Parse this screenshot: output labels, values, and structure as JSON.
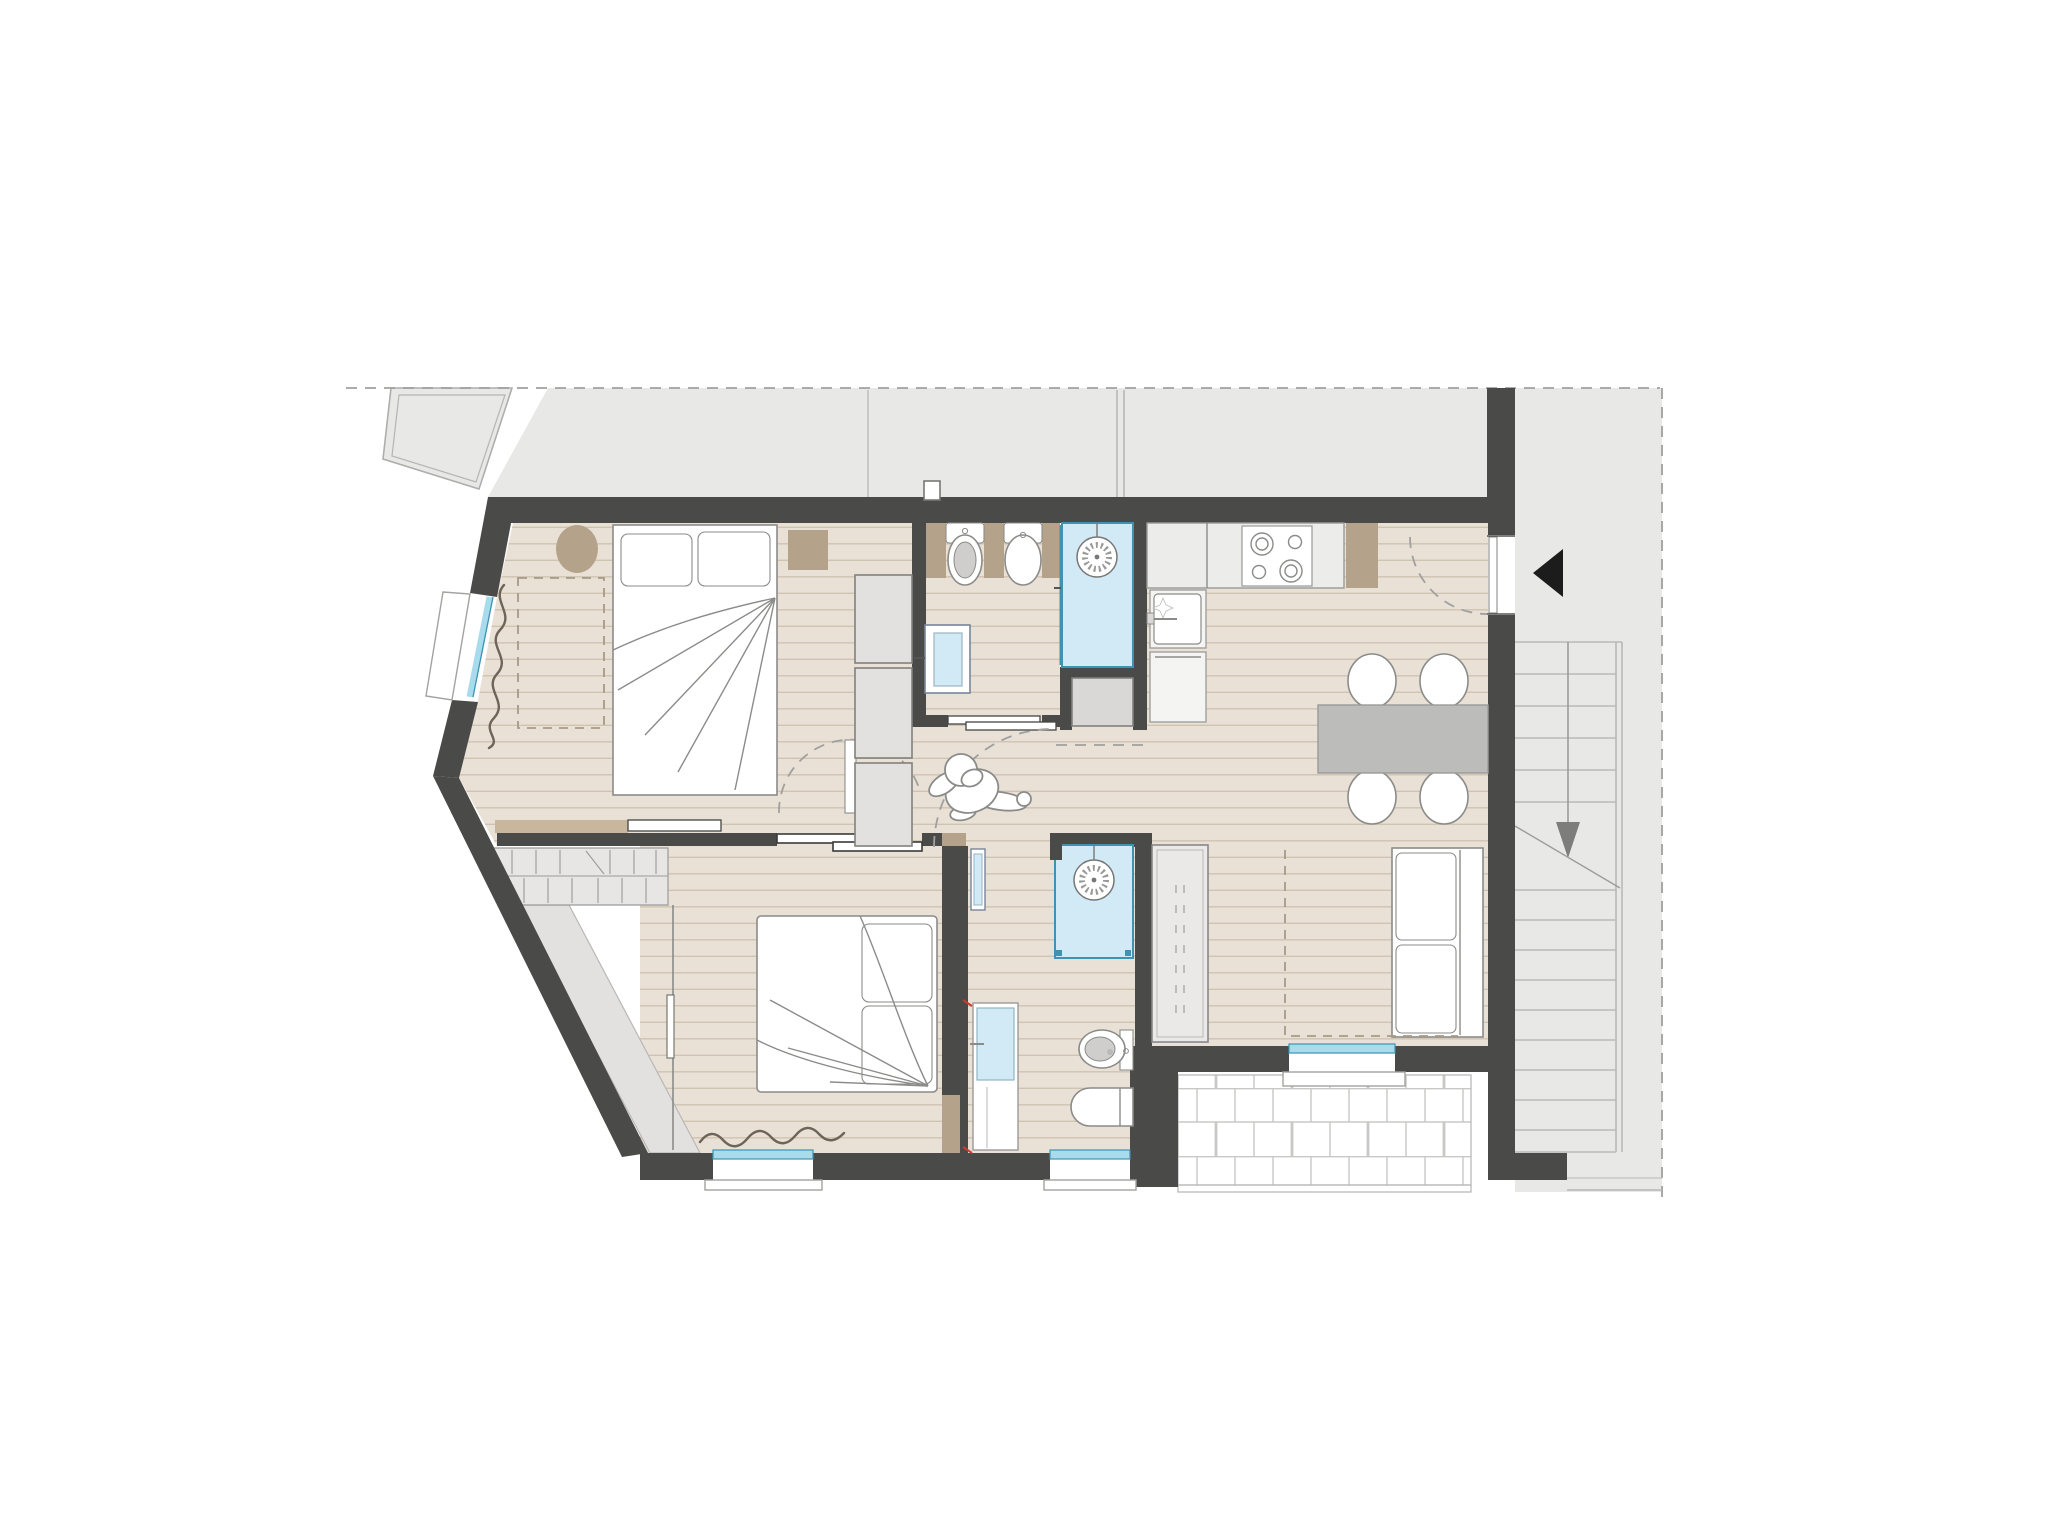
{
  "palette": {
    "page": "#ffffff",
    "outside": "#e8e8e6",
    "wall": "#4a4a48",
    "floor": "#e9e1d6",
    "plank": "#cfc3b2",
    "tan": "#b4a38a",
    "tan-light": "#c8b69d",
    "glass-fill": "#d2eaf5",
    "glass-stroke": "#3f93b0",
    "window-blue": "#a8dcec",
    "furn-stroke": "#8b8b89",
    "gray-fill": "#e2e1df",
    "gray-stroke": "#81807c",
    "box-gray": "#d9d8d6",
    "table": "#bcbcba",
    "tile-line": "#c8c8c6",
    "stair-line": "#b9b9b7",
    "dash": "#a0a09e",
    "dash-roof": "#a89a87",
    "curtain": "#6f6458",
    "arrow-dark": "#1c1c1c",
    "arrow-gray": "#7d7d7b"
  },
  "site": {
    "context": [
      "neighbor-building-outline",
      "property-line-dashed",
      "shared-stairwell"
    ],
    "stairwell": {
      "upper_flight_treads": 6,
      "lower_flight_treads": 9,
      "direction_arrow": "down",
      "break_line": true
    },
    "entrance_arrow_direction": "left"
  },
  "plan": {
    "rooms": [
      {
        "name": "bedroom-1",
        "fixtures": [
          "double-bed-icon",
          "pillow-icon",
          "pillow-icon",
          "stool-icon",
          "nightstand-icon",
          "wardrobe-3-sections-icon",
          "sideboard-icon",
          "window-with-curtain-icon",
          "roof-slope-dashed-outline"
        ]
      },
      {
        "name": "bathroom-1",
        "fixtures": [
          "toilet-icon",
          "bidet-icon",
          "shower-icon",
          "glass-door-icon",
          "wall-cabinet-icon",
          "vent-stub-icon"
        ]
      },
      {
        "name": "utility-niche",
        "fixtures": [
          "appliance-box-icon"
        ]
      },
      {
        "name": "kitchen",
        "fixtures": [
          "counter-icon",
          "cooktop-4-burners-icon",
          "sink-with-faucet-icon",
          "sparkle-icon",
          "tall-unit-icon",
          "tan-cabinet-icon",
          "entrance-door-swing-arc"
        ]
      },
      {
        "name": "dining-area",
        "fixtures": [
          "table-icon",
          "chair-icon",
          "chair-icon",
          "chair-icon",
          "chair-icon"
        ]
      },
      {
        "name": "living-area",
        "fixtures": [
          "sofa-icon",
          "tall-cabinet-icon",
          "roof-slope-dashed-line",
          "balcony-door-icon"
        ]
      },
      {
        "name": "hallway",
        "fixtures": [
          "person-figure-icon",
          "door-swing-arc",
          "door-swing-arc",
          "open-door-leaf-icon",
          "sliding-door-icon"
        ]
      },
      {
        "name": "bedroom-2",
        "fixtures": [
          "double-bed-icon",
          "pillow-icon",
          "pillow-icon",
          "built-in-wardrobe-icon",
          "under-roof-storage-hatched",
          "window-with-curtain-icon",
          "sloped-ceiling-zone"
        ]
      },
      {
        "name": "bathroom-2",
        "fixtures": [
          "shower-icon",
          "bidet-icon",
          "toilet-icon",
          "washbasin-cabinet-icon",
          "glass-door-leaf-icon",
          "window-icon"
        ]
      },
      {
        "name": "balcony",
        "fixtures": [
          "tile-grid",
          "threshold-step-icon"
        ]
      }
    ]
  }
}
